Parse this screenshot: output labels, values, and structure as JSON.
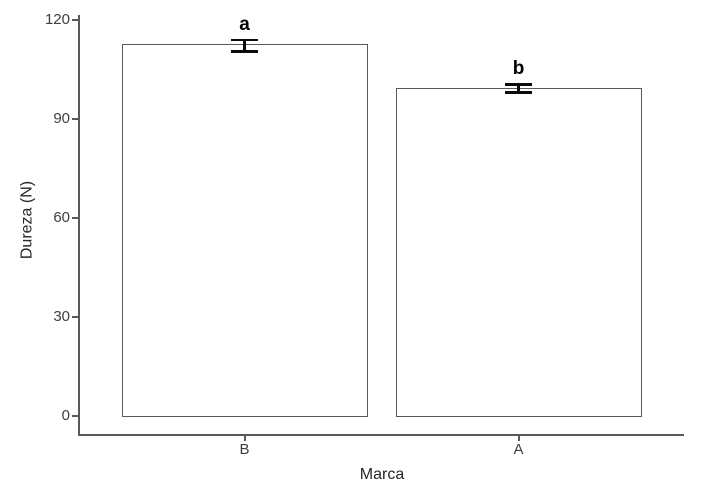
{
  "figure": {
    "background": "#ffffff"
  },
  "chart_data": {
    "type": "bar",
    "title": "",
    "xlabel": "Marca",
    "ylabel": "Dureza (N)",
    "categories": [
      "B",
      "A"
    ],
    "values": [
      112.5,
      99
    ],
    "error_bars": {
      "upper": [
        114,
        100.5
      ],
      "lower": [
        110.5,
        98
      ]
    },
    "sig_letters": [
      "a",
      "b"
    ],
    "yticks": [
      0,
      30,
      60,
      90,
      120
    ],
    "ylim": [
      0,
      120
    ],
    "grid": false,
    "legend": false,
    "bar_fill": "#ffffff",
    "bar_border": "#595959",
    "axis_color": "#595959",
    "tick_label_color": "#404040",
    "error_bar_color": "#0a0a0a",
    "sig_letter_color": "#000000"
  }
}
